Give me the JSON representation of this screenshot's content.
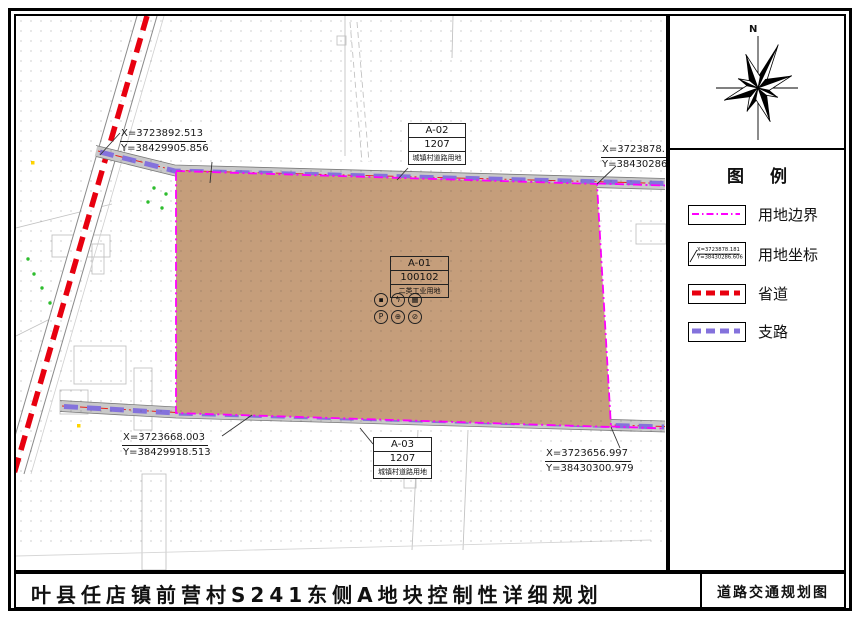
{
  "title_bar": {
    "title": "叶县任店镇前营村S241东侧A地块控制性详细规划",
    "drawing_name": "道路交通规划图"
  },
  "north_arrow": {
    "label": "N"
  },
  "legend": {
    "title": "图 例",
    "items": [
      {
        "label": "用地边界"
      },
      {
        "label": "用地坐标",
        "sample_x": "X=3723878.181",
        "sample_y": "Y=38430286.606"
      },
      {
        "label": "省道"
      },
      {
        "label": "支路"
      }
    ]
  },
  "parcels": {
    "a01": {
      "code": "A-01",
      "use_code": "100102",
      "use_name": "二类工业用地",
      "facility_icons": [
        {
          "name": "waste-facility-icon",
          "glyph": "▪"
        },
        {
          "name": "power-facility-icon",
          "glyph": "ϟ"
        },
        {
          "name": "toilet-facility-icon",
          "glyph": "▦"
        },
        {
          "name": "parking-icon",
          "glyph": "P"
        },
        {
          "name": "facility-icon-5",
          "glyph": "⊕"
        },
        {
          "name": "facility-icon-6",
          "glyph": "⊘"
        }
      ]
    },
    "a02": {
      "code": "A-02",
      "use_code": "1207",
      "use_name": "城镇村道路用地"
    },
    "a03": {
      "code": "A-03",
      "use_code": "1207",
      "use_name": "城镇村道路用地"
    }
  },
  "coordinates": {
    "top_left": {
      "x": "X=3723892.513",
      "y": "Y=38429905.856"
    },
    "top_right": {
      "x": "X=3723878.181",
      "y": "Y=38430286.606"
    },
    "bottom_left": {
      "x": "X=3723668.003",
      "y": "Y=38429918.513"
    },
    "bottom_right": {
      "x": "X=3723656.997",
      "y": "Y=38430300.979"
    }
  },
  "colors": {
    "parcel": "#C59E7B",
    "boundary": "#FF00FF",
    "provincial_road": "#E8000F",
    "branch_road": "#8472DC",
    "road_fill": "#C9C9C9"
  }
}
